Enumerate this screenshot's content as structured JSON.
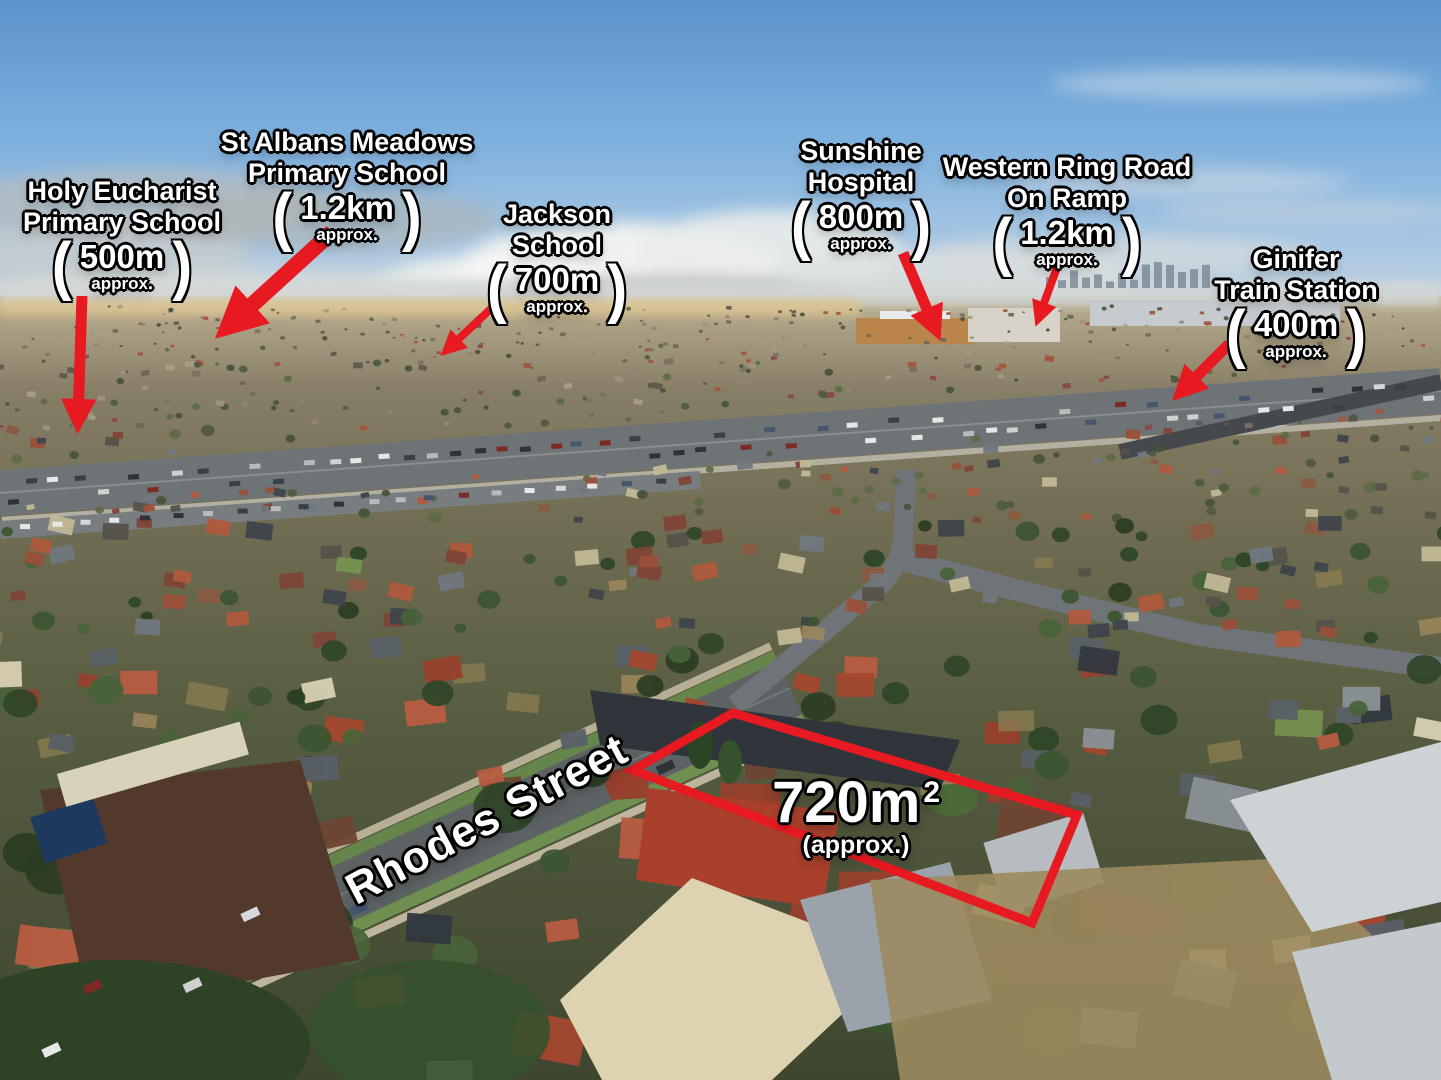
{
  "scene_description": "aerial drone photo of suburban St Albans with landmark distance callouts",
  "punct": {
    "open": "(",
    "close": ")"
  },
  "landmarks": [
    {
      "id": "holy-eucharist",
      "name_lines": [
        "Holy Eucharist",
        "Primary School"
      ],
      "distance": "500m",
      "approx": "approx."
    },
    {
      "id": "st-albans-meadows",
      "name_lines": [
        "St Albans Meadows",
        "Primary School"
      ],
      "distance": "1.2km",
      "approx": "approx."
    },
    {
      "id": "jackson-school",
      "name_lines": [
        "Jackson",
        "School"
      ],
      "distance": "700m",
      "approx": "approx."
    },
    {
      "id": "sunshine-hospital",
      "name_lines": [
        "Sunshine",
        "Hospital"
      ],
      "distance": "800m",
      "approx": "approx."
    },
    {
      "id": "western-ring-road",
      "name_lines": [
        "Western Ring Road",
        "On Ramp"
      ],
      "distance": "1.2km",
      "approx": "approx."
    },
    {
      "id": "ginifer-station",
      "name_lines": [
        "Ginifer",
        "Train Station"
      ],
      "distance": "400m",
      "approx": "approx."
    }
  ],
  "street": {
    "name": "Rhodes Street"
  },
  "area": {
    "value": "720m",
    "sup": "2",
    "approx": "(approx.)"
  },
  "colors": {
    "annotation_red": "#e81a21",
    "text_white": "#ffffff",
    "outline_black": "#000000"
  }
}
